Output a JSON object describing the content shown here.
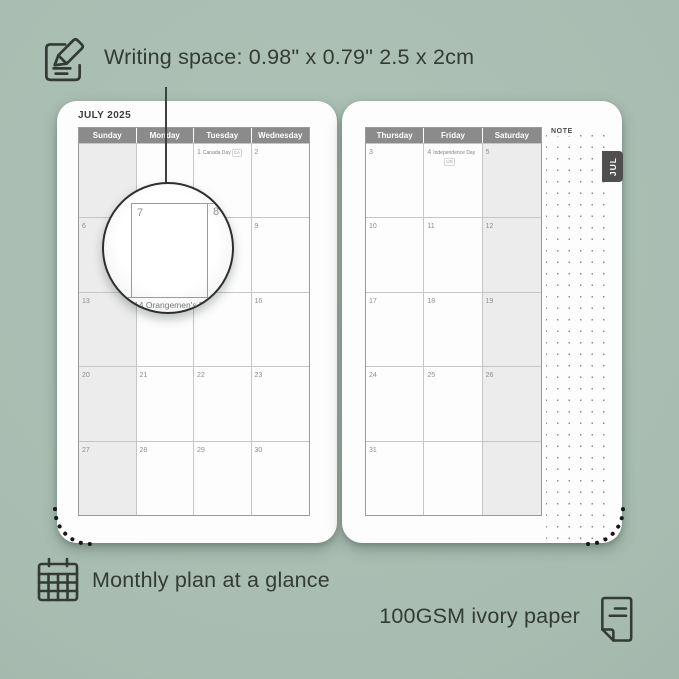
{
  "colors": {
    "background": "#a9bdb2",
    "ink": "#333b37",
    "page": "#fdfdfd",
    "header_bg": "#8b8b8b",
    "weekend_bg": "#ececec",
    "grid_line": "#c6c6c6",
    "table_border": "#9a9a9a",
    "date_number": "#8f8f8f",
    "tab_bg": "#4f4f4f"
  },
  "annotations": {
    "writing_space": "Writing space: 0.98\" x 0.79\" 2.5 x 2cm",
    "monthly_plan": "Monthly plan at a glance",
    "paper": "100GSM ivory paper"
  },
  "icons": {
    "top_left": "note-pencil-icon",
    "bottom_left": "calendar-grid-icon",
    "bottom_right": "paper-sheet-icon"
  },
  "planner": {
    "month_title": "JULY 2025",
    "tab_label": "JUL",
    "note_label": "NOTE",
    "left_page": {
      "headers": [
        "Sunday",
        "Monday",
        "Tuesday",
        "Wednesday"
      ],
      "weekend_col": 0,
      "weeks": [
        [
          null,
          null,
          {
            "d": "1",
            "h": "Canada Day",
            "t": "CA"
          },
          {
            "d": "2"
          }
        ],
        [
          {
            "d": "6"
          },
          {
            "d": "7"
          },
          {
            "d": "8"
          },
          {
            "d": "9"
          }
        ],
        [
          {
            "d": "13"
          },
          {
            "d": "14",
            "h": "Orangemen's Day"
          },
          {
            "d": "15"
          },
          {
            "d": "16"
          }
        ],
        [
          {
            "d": "20"
          },
          {
            "d": "21"
          },
          {
            "d": "22"
          },
          {
            "d": "23"
          }
        ],
        [
          {
            "d": "27"
          },
          {
            "d": "28"
          },
          {
            "d": "29"
          },
          {
            "d": "30"
          }
        ]
      ]
    },
    "right_page": {
      "headers": [
        "Thursday",
        "Friday",
        "Saturday"
      ],
      "weekend_col": 2,
      "weeks": [
        [
          {
            "d": "3"
          },
          {
            "d": "4",
            "h": "Independence Day",
            "t": "US",
            "tb": true
          },
          {
            "d": "5"
          }
        ],
        [
          {
            "d": "10"
          },
          {
            "d": "11"
          },
          {
            "d": "12"
          }
        ],
        [
          {
            "d": "17"
          },
          {
            "d": "18"
          },
          {
            "d": "19"
          }
        ],
        [
          {
            "d": "24"
          },
          {
            "d": "25"
          },
          {
            "d": "26"
          }
        ],
        [
          {
            "d": "31"
          },
          null,
          null
        ]
      ]
    },
    "magnifier": {
      "day_left": "7",
      "day_right": "8",
      "holiday_line": "14  Orangemen's Day"
    }
  }
}
